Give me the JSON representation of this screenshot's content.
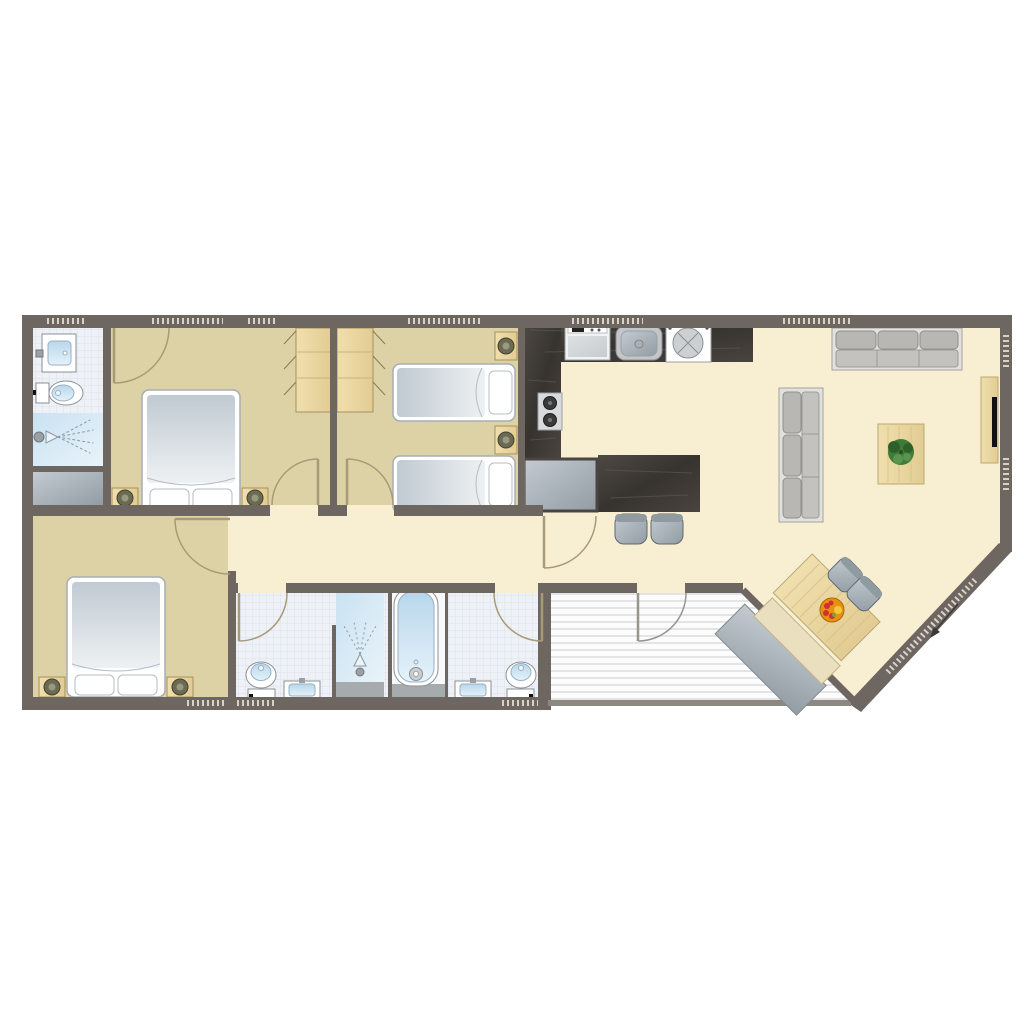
{
  "meta": {
    "title": "apartment-floor-plan",
    "canvas_width": 1024,
    "canvas_height": 1024
  },
  "palette": {
    "bg": "#ffffff",
    "wall": "#6e6661",
    "wall-thin": "#8d8781",
    "window": "#d8d1c6",
    "floor-cream": "#f8eed2",
    "floor-tan": "#ddd2a6",
    "tile": "#eef2f7",
    "tile-grid": "#d7dfe9",
    "shower-a": "#c9e2f2",
    "shower-b": "#e9f3f9",
    "ledge-gray": "#a6abae",
    "deck-bg": "#fcfcfc",
    "deck-line": "#d9d9d9",
    "counter-a": "#4e4945",
    "counter-b": "#37332f",
    "steel-a": "#c3cbd1",
    "steel-b": "#929ca3",
    "wood-a": "#f0dfae",
    "wood-b": "#e2cc93",
    "wood-line": "#c9b27b",
    "fixture-stroke": "#8b9094",
    "basin-a": "#b8d7ec",
    "basin-b": "#e5f2fa",
    "mattress-a": "#c0cad2",
    "mattress-b": "#eef1f3",
    "sofa-frame": "#e1e1dd",
    "sofa-cushion": "#b9b7b4",
    "sofa-seat": "#c4c2bf",
    "door-arc": "#a89a78",
    "lamp": "#6b6a55",
    "plant": "#3f7c39",
    "fruit-orange": "#e89012",
    "fruit-red": "#d03030",
    "fruit-yellow": "#f4c83c",
    "arrow": "#3a3a3a",
    "white": "#ffffff"
  },
  "legend": {
    "rooms": [
      {
        "id": "bathroom-1",
        "label": "shower room (top left)"
      },
      {
        "id": "bedroom-1",
        "label": "double bedroom (top left)"
      },
      {
        "id": "bedroom-2",
        "label": "twin bedroom (top middle)"
      },
      {
        "id": "kitchen",
        "label": "kitchen"
      },
      {
        "id": "living-room",
        "label": "living room"
      },
      {
        "id": "hallway",
        "label": "hallway"
      },
      {
        "id": "bedroom-3",
        "label": "double bedroom (bottom left)"
      },
      {
        "id": "bathroom-2",
        "label": "shower room (bottom)"
      },
      {
        "id": "bathroom-3",
        "label": "bathroom with bathtub (bottom)"
      },
      {
        "id": "terrace",
        "label": "decked terrace"
      },
      {
        "id": "storage",
        "label": "storage nook"
      }
    ],
    "furniture_counts": {
      "double_beds": 2,
      "single_beds": 2,
      "wardrobes": 2,
      "nightstands": 6,
      "sofas": 2,
      "coffee_tables": 1,
      "tv_cabinets": 1,
      "dining_tables": 1,
      "benches": 2,
      "dining_chairs": 2,
      "bar_stools": 2,
      "toilets": 3,
      "washbasins": 3,
      "showers": 2,
      "bathtubs": 1,
      "kitchen_appliances": [
        "dishwasher",
        "sink",
        "washing-machine",
        "cooktop",
        "fridge"
      ]
    },
    "entrance_arrow_direction": "southwest"
  }
}
